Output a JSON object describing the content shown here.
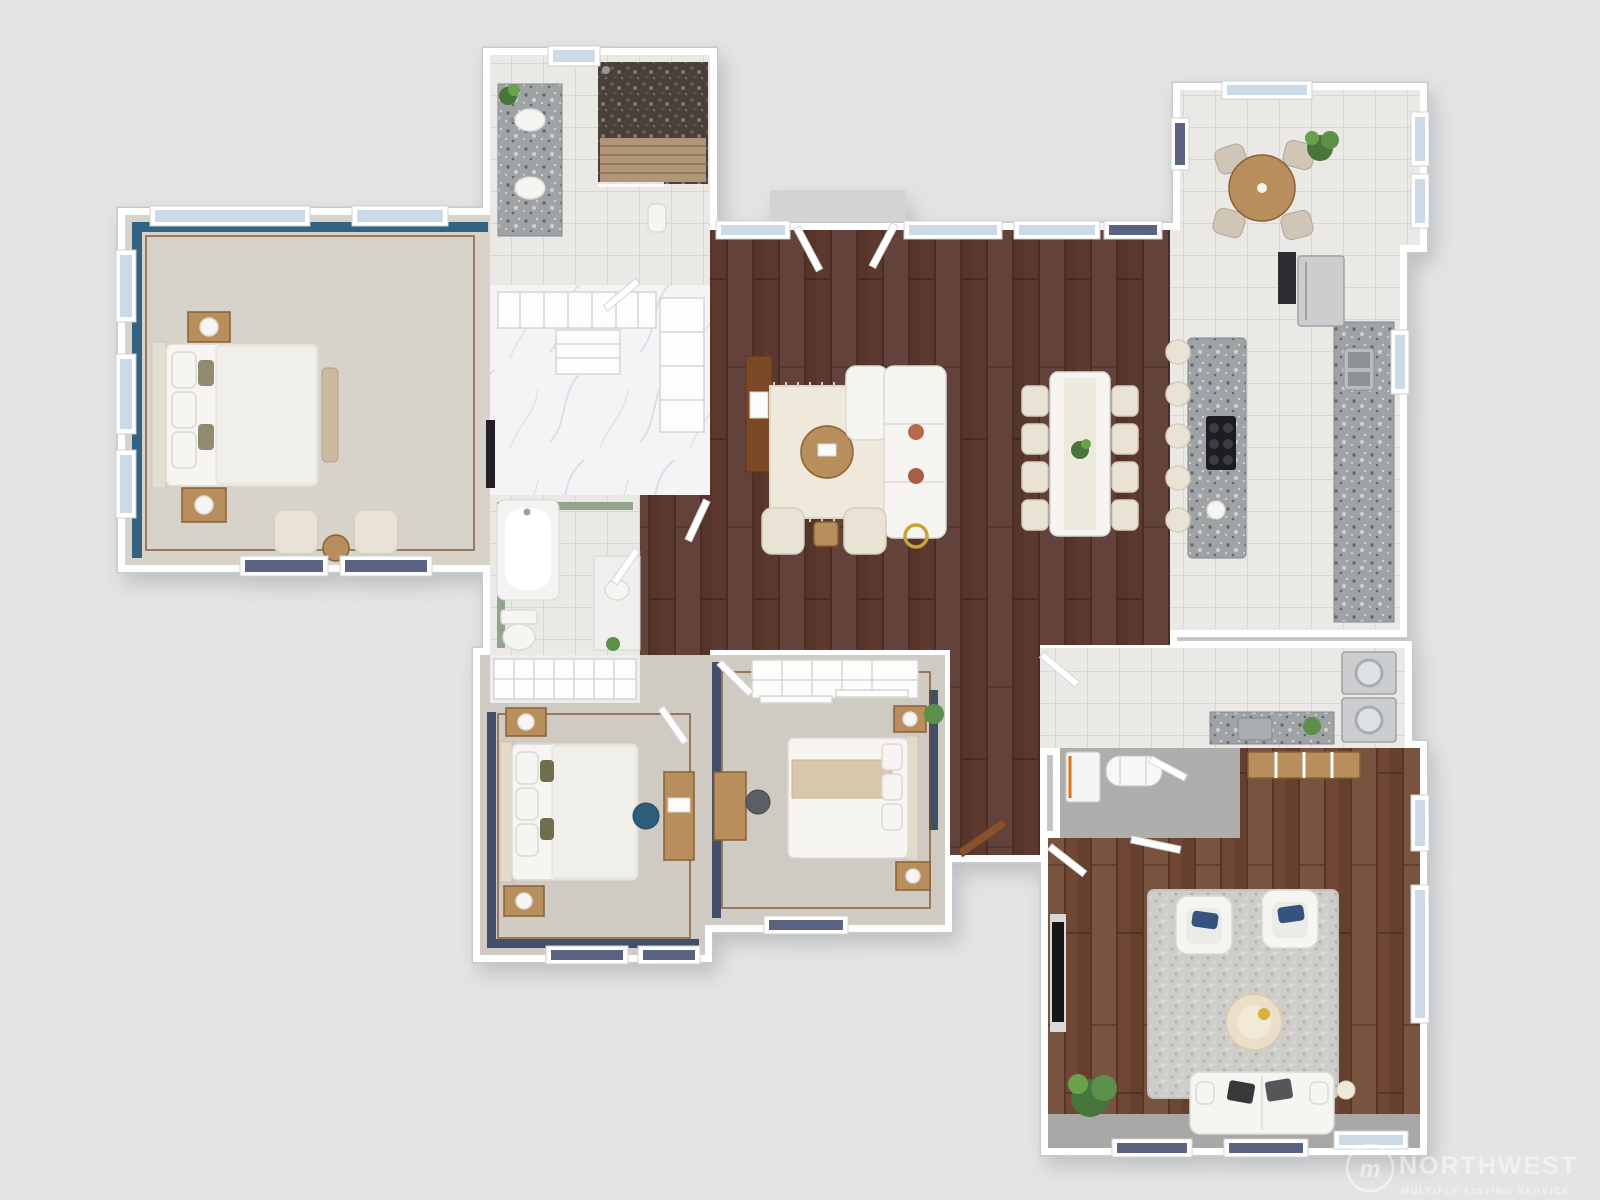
{
  "watermark": {
    "logo_letter": "m",
    "brand": "NORTHWEST",
    "subtitle": "MULTIPLE LISTING SERVICE."
  },
  "palette": {
    "bg": "#e3e4e6",
    "wall": "#ffffff",
    "wall_edge": "#c8c9cb",
    "glass": "#ccd9e7",
    "wood_living": "#5b392f",
    "wood_living_seam": "#492d26",
    "wood_family": "#6f4734",
    "wood_family_seam": "#583527",
    "tile": "#eae9e5",
    "grout": "#d9d7d1",
    "marble": "#f4f3f5",
    "marble_vein": "#dcdbe1",
    "carpet_master": "#d7d3ca",
    "carpet_bed": "#cfcbc3",
    "concrete": "#aeaeac",
    "granite": "#9fa3a6",
    "granite_dark": "#63676b",
    "granite_light": "#ced1d3",
    "pebble_base": "#48413a",
    "slat": "#b2967a",
    "slat_dark": "#94785c",
    "accent_blue": "#336383",
    "accent_navy": "#3f4f6b",
    "accent_green": "#93a48d",
    "trim": "#7d4a2a",
    "furn_wood": "#b98e5d",
    "furn_wood_dark": "#8a6136",
    "cream": "#e9e3d6",
    "fabric_white": "#f6f5f2",
    "door_wood": "#8a512f"
  },
  "floor_plan": {
    "type": "3d-top-down-residential-floor-plan",
    "rooms": [
      {
        "id": "primary-bedroom",
        "floor": "carpet",
        "wall_accent": "teal-blue",
        "furniture": [
          "king-bed",
          "nightstand",
          "nightstand",
          "table-lamp",
          "table-lamp",
          "foot-bench",
          "accent-chair",
          "accent-chair",
          "round-side-table",
          "wall-tv"
        ]
      },
      {
        "id": "primary-bathroom",
        "floor": "tile",
        "furniture": [
          "double-sink-vanity",
          "walk-in-shower",
          "shower-bench",
          "plant",
          "stool"
        ]
      },
      {
        "id": "walk-in-closet",
        "floor": "marble",
        "furniture": [
          "shelving-unit",
          "shelving-unit",
          "shelving-unit"
        ]
      },
      {
        "id": "hall-bathroom",
        "floor": "tile",
        "wall_accent": "sage-green",
        "furniture": [
          "bathtub",
          "toilet",
          "vanity",
          "plant"
        ]
      },
      {
        "id": "linen-closet",
        "floor": "carpet",
        "furniture": [
          "wire-shelving"
        ]
      },
      {
        "id": "hallway",
        "floor": "hardwood",
        "furniture": []
      },
      {
        "id": "bedroom-2",
        "floor": "carpet",
        "wall_accent": "navy",
        "furniture": [
          "queen-bed",
          "nightstand",
          "nightstand",
          "desk",
          "desk-chair"
        ]
      },
      {
        "id": "bedroom-3",
        "floor": "carpet",
        "wall_accent": "navy",
        "furniture": [
          "queen-bed",
          "nightstand",
          "nightstand",
          "desk",
          "desk-chair",
          "closet-shelving",
          "dresser",
          "plant"
        ]
      },
      {
        "id": "great-room",
        "floor": "hardwood",
        "furniture": [
          "sectional-sofa",
          "area-rug",
          "round-coffee-table",
          "accent-chair",
          "accent-chair",
          "side-table",
          "gold-side-table",
          "media-cabinet",
          "dining-table",
          "dining-chair",
          "dining-chair",
          "dining-chair",
          "dining-chair",
          "dining-chair",
          "dining-chair",
          "dining-chair",
          "dining-chair",
          "centerpiece-plant"
        ]
      },
      {
        "id": "kitchen",
        "floor": "tile",
        "furniture": [
          "granite-island",
          "gas-cooktop",
          "bar-stool",
          "bar-stool",
          "bar-stool",
          "bar-stool",
          "bar-stool",
          "perimeter-counter",
          "double-sink",
          "refrigerator",
          "wall-oven"
        ]
      },
      {
        "id": "breakfast-nook",
        "floor": "tile",
        "furniture": [
          "round-table",
          "chair",
          "chair",
          "chair",
          "chair",
          "plant"
        ]
      },
      {
        "id": "laundry-room",
        "floor": "tile",
        "furniture": [
          "washer",
          "dryer",
          "utility-sink-counter",
          "plant",
          "bench-cubbies"
        ]
      },
      {
        "id": "utility-room",
        "floor": "concrete",
        "furniture": [
          "water-heater",
          "furnace"
        ]
      },
      {
        "id": "family-room",
        "floor": "hardwood",
        "furniture": [
          "sofa",
          "armchair",
          "armchair",
          "shag-rug",
          "round-ottoman",
          "fireplace",
          "floor-lamp",
          "plant"
        ]
      }
    ]
  }
}
